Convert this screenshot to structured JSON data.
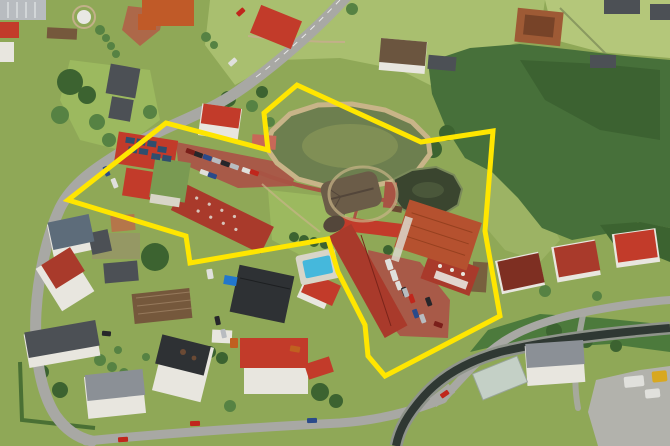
{
  "scene": {
    "kind": "aerial-photograph",
    "subject": "village resort property with ponds marked by a yellow boundary overlay"
  },
  "boundary": {
    "color": "#ffe600",
    "points": "68,200 166,123 268,150 264,113 297,85 421,142 493,131 485,231 500,316 385,376 368,356 365,325 338,272 328,239 190,263 186,236"
  },
  "palette": {
    "grass": "#8fa857",
    "grass_light": "#9cb95f",
    "meadow": "#a9bf6f",
    "meadow_pale": "#b4c77a",
    "slope": "#9cb364",
    "forest": "#47703a",
    "forest_dark": "#35592c",
    "tree": "#4c7a3c",
    "tree_dark": "#3c6330",
    "tree_light": "#568243",
    "hedge": "#4a7034",
    "road": "#a8a8a4",
    "road_light": "#b2b2ac",
    "path_brick": "#a85444",
    "path_sand": "#c8b488",
    "courtyard": "#b06048",
    "parking_brick": "#a85a48",
    "pond_main": "#6d7f4f",
    "pond_glint": "#97a55e",
    "pond_dark": "#3a452f",
    "pond_edge": "#7a8a5a",
    "stream": "#2f3833",
    "stream_bank": "#8f948b",
    "roof_red": "#c23b2a",
    "roof_red2": "#a93a2b",
    "roof_terracotta": "#b5512f",
    "roof_darkred": "#7e2f22",
    "roof_orange_bldg": "#c05a28",
    "roof_gray": "#8b9096",
    "roof_dark": "#4c5055",
    "roof_black": "#2e3134",
    "roof_blue": "#5d6c7a",
    "thatch": "#6b5c48",
    "thatch_dark": "#53463a",
    "wall_white": "#e8e6df",
    "wall_cream": "#ddd2b8",
    "wall_green": "#7a9a52",
    "wall_brick": "#9e5a35",
    "solar": "#2f4e6e",
    "pool": "#45b8dc",
    "pool_deck": "#d8d5c8",
    "soil": "#8a6a48",
    "garden_soil": "#75583c",
    "dirt_yard": "#9b8a70",
    "glasshouse": "#c9d4d0",
    "tarp_blue": "#2277cc",
    "car_red": "#c0261c",
    "car_white": "#e0e0dc",
    "car_black": "#26262a",
    "car_blue": "#2a4a8a",
    "car_silver": "#b8bcc0",
    "car_darkred": "#7a1f1a",
    "truck_yellow": "#d8a820",
    "truck_orange": "#c06020"
  }
}
